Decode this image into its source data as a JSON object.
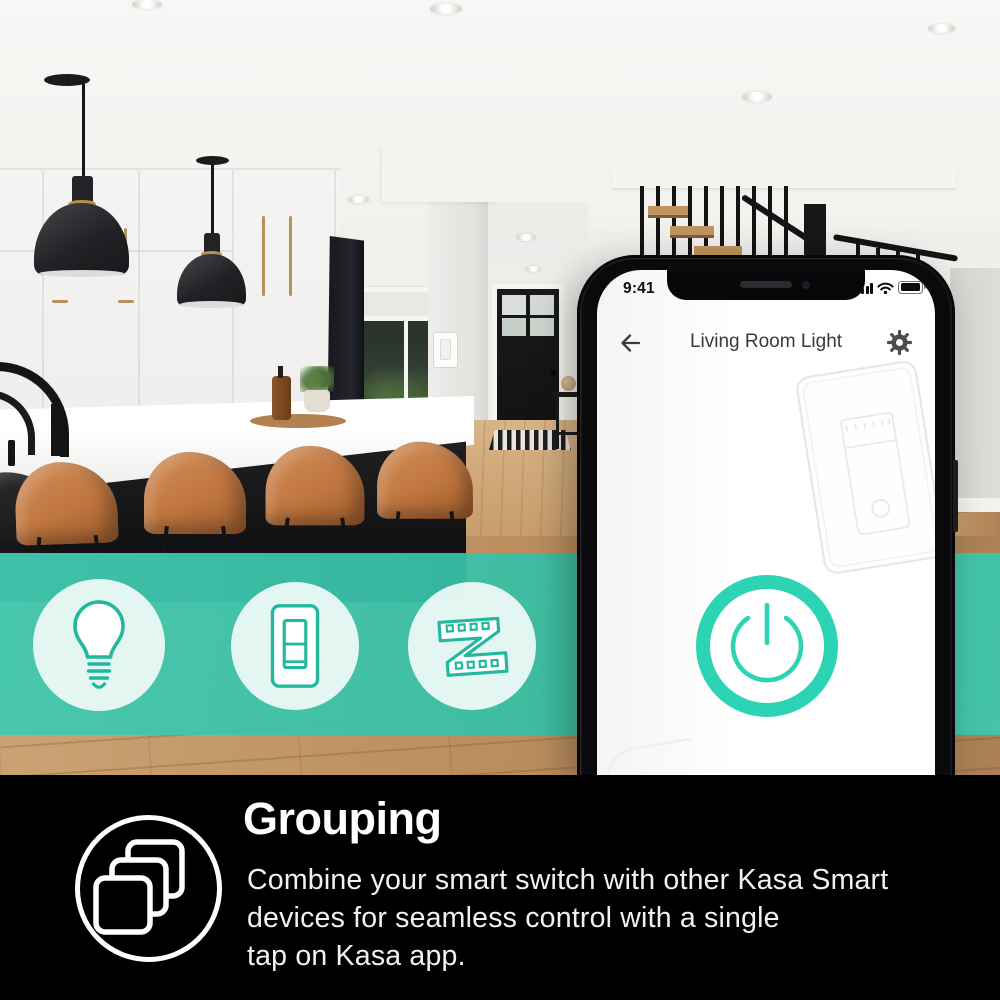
{
  "colors": {
    "accent_teal": "#2cd4b3",
    "banner_teal": "#3ec6ad",
    "icon_stroke_teal": "#21b89e",
    "mint_circle": "#ecf9f5",
    "feature_background": "#000000"
  },
  "phone": {
    "status_bar": {
      "time": "9:41"
    },
    "header": {
      "title": "Living Room Light"
    }
  },
  "banner": {
    "icons": [
      {
        "name": "smart-bulb-icon"
      },
      {
        "name": "smart-wall-switch-icon"
      },
      {
        "name": "led-light-strip-icon"
      }
    ]
  },
  "feature": {
    "heading": "Grouping",
    "description_lines": [
      "Combine your smart switch with other Kasa Smart",
      "devices for seamless control with a single",
      "tap on Kasa app."
    ]
  }
}
